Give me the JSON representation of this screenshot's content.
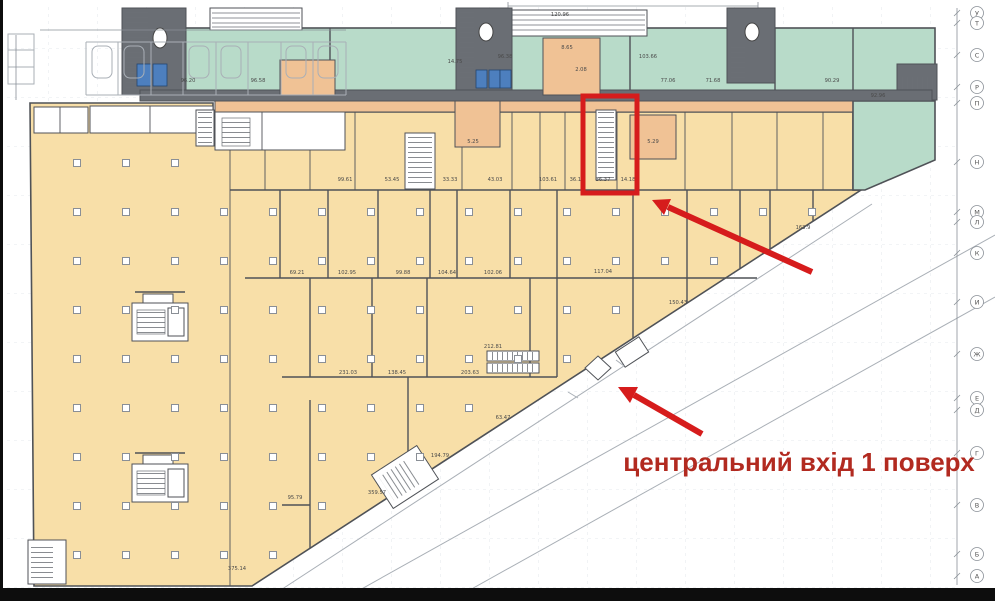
{
  "annotation": {
    "label": "центральний вхід 1 поверх"
  },
  "highlighted_unit": {
    "labels": [
      "36.37",
      "14.18"
    ]
  },
  "colors": {
    "tan": "#f8dfa8",
    "green": "#b8dbc9",
    "core_gray": "#6a6e74",
    "corridor_orange": "#f0c295",
    "elevator_blue": "#4d7fbe",
    "wall": "#4f5257",
    "annotation_red": "#d61c1c",
    "text_red": "#b22a20",
    "grid": "#dbe0e5"
  },
  "room_labels": [
    {
      "x": 345,
      "y": 181,
      "t": "99.61"
    },
    {
      "x": 392,
      "y": 181,
      "t": "53.45"
    },
    {
      "x": 450,
      "y": 181,
      "t": "33.33"
    },
    {
      "x": 495,
      "y": 181,
      "t": "43.03"
    },
    {
      "x": 548,
      "y": 181,
      "t": "103.61"
    },
    {
      "x": 577,
      "y": 181,
      "t": "36.14"
    },
    {
      "x": 603,
      "y": 181,
      "t": "36.37"
    },
    {
      "x": 628,
      "y": 181,
      "t": "14.18"
    },
    {
      "x": 188,
      "y": 82,
      "t": "96.20"
    },
    {
      "x": 258,
      "y": 82,
      "t": "96.58"
    },
    {
      "x": 455,
      "y": 63,
      "t": "14.75"
    },
    {
      "x": 505,
      "y": 58,
      "t": "96.38"
    },
    {
      "x": 560,
      "y": 16,
      "t": "120.96"
    },
    {
      "x": 648,
      "y": 58,
      "t": "103.66"
    },
    {
      "x": 668,
      "y": 82,
      "t": "77.06"
    },
    {
      "x": 713,
      "y": 82,
      "t": "71.68"
    },
    {
      "x": 832,
      "y": 82,
      "t": "90.29"
    },
    {
      "x": 878,
      "y": 97,
      "t": "92.96"
    },
    {
      "x": 567,
      "y": 49,
      "t": "8.65"
    },
    {
      "x": 581,
      "y": 71,
      "t": "2.08"
    },
    {
      "x": 653,
      "y": 143,
      "t": "5.29"
    },
    {
      "x": 473,
      "y": 143,
      "t": "5.25"
    },
    {
      "x": 297,
      "y": 274,
      "t": "69.21"
    },
    {
      "x": 347,
      "y": 274,
      "t": "102.95"
    },
    {
      "x": 403,
      "y": 274,
      "t": "99.88"
    },
    {
      "x": 447,
      "y": 274,
      "t": "104.64"
    },
    {
      "x": 493,
      "y": 274,
      "t": "102.06"
    },
    {
      "x": 603,
      "y": 273,
      "t": "117.04"
    },
    {
      "x": 348,
      "y": 374,
      "t": "231.03"
    },
    {
      "x": 397,
      "y": 374,
      "t": "138.45"
    },
    {
      "x": 470,
      "y": 374,
      "t": "203.63"
    },
    {
      "x": 493,
      "y": 348,
      "t": "212.81"
    },
    {
      "x": 803,
      "y": 229,
      "t": "163.9"
    },
    {
      "x": 678,
      "y": 304,
      "t": "150.43"
    },
    {
      "x": 295,
      "y": 499,
      "t": "95.79"
    },
    {
      "x": 377,
      "y": 494,
      "t": "359.57"
    },
    {
      "x": 440,
      "y": 457,
      "t": "194.79"
    },
    {
      "x": 503,
      "y": 419,
      "t": "63.47"
    },
    {
      "x": 237,
      "y": 570,
      "t": "375.14"
    }
  ],
  "grid_axis": {
    "letters": [
      {
        "y": 13,
        "ch": "У"
      },
      {
        "y": 23,
        "ch": "Т"
      },
      {
        "y": 55,
        "ch": "С"
      },
      {
        "y": 87,
        "ch": "Р"
      },
      {
        "y": 103,
        "ch": "П"
      },
      {
        "y": 162,
        "ch": "Н"
      },
      {
        "y": 212,
        "ch": "М"
      },
      {
        "y": 222,
        "ch": "Л"
      },
      {
        "y": 253,
        "ch": "К"
      },
      {
        "y": 302,
        "ch": "И"
      },
      {
        "y": 354,
        "ch": "Ж"
      },
      {
        "y": 398,
        "ch": "Е"
      },
      {
        "y": 410,
        "ch": "Д"
      },
      {
        "y": 453,
        "ch": "Г"
      },
      {
        "y": 505,
        "ch": "В"
      },
      {
        "y": 554,
        "ch": "Б"
      },
      {
        "y": 576,
        "ch": "А"
      }
    ]
  }
}
